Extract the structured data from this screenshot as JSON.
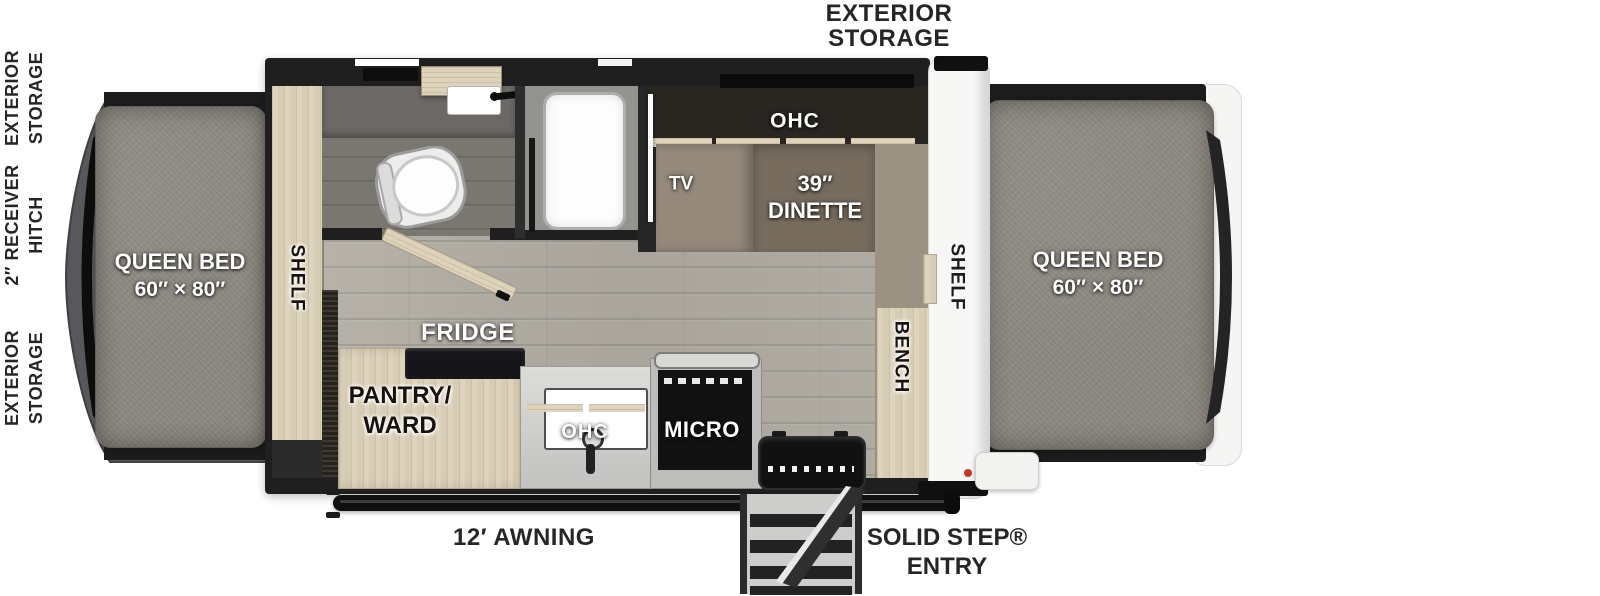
{
  "colors": {
    "wall": "#1f1f1f",
    "floor_wood": "#b3afa6",
    "cabinet_wood": "#ded4be",
    "mattress_gray": "#8d8981",
    "dinette_taupe": "#776c5e",
    "label_dark": "#262626",
    "accent_red": "#c0392b",
    "tent_white": "#f7f7f6"
  },
  "exterior_left": {
    "storage_top": {
      "line1": "EXTERIOR",
      "line2": "STORAGE"
    },
    "receiver_hitch": {
      "line1": "2″ RECEIVER",
      "line2": "HITCH"
    },
    "storage_bottom": {
      "line1": "EXTERIOR",
      "line2": "STORAGE"
    }
  },
  "exterior_top": {
    "storage": {
      "line1": "EXTERIOR",
      "line2": "STORAGE"
    }
  },
  "bed_left": {
    "line1": "QUEEN BED",
    "line2": "60″ × 80″"
  },
  "bed_right": {
    "line1": "QUEEN BED",
    "line2": "60″ × 80″"
  },
  "interior": {
    "shelf_left": "SHELF",
    "shelf_right": "SHELF",
    "bench": "BENCH",
    "tv": "TV",
    "dinette_ohc": "OHC",
    "dinette": {
      "line1": "39″",
      "line2": "DINETTE"
    },
    "fridge": "FRIDGE",
    "pantry": {
      "line1": "PANTRY/",
      "line2": "WARD"
    },
    "kitchen_ohc": "OHC",
    "micro": "MICRO"
  },
  "exterior_bottom": {
    "awning": "12′ AWNING",
    "solid_step": {
      "line1": "SOLID STEP®",
      "line2": "ENTRY"
    }
  }
}
